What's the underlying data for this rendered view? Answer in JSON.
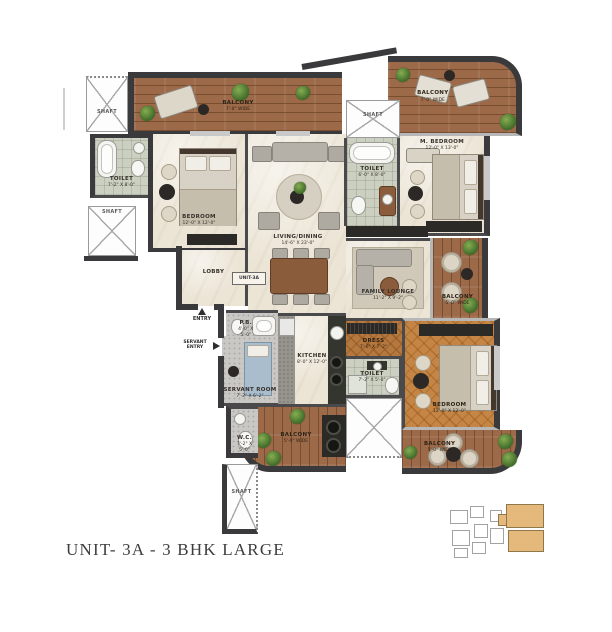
{
  "title": "UNIT- 3A - 3 BHK LARGE",
  "plan": {
    "unit_tag": "UNIT-3A",
    "entry_label": "ENTRY",
    "servant_entry_label": "SERVANT ENTRY"
  },
  "rooms": {
    "shaft_top_left": {
      "name": "SHAFT",
      "dims": ""
    },
    "balcony_top": {
      "name": "BALCONY",
      "dims": "7'-0\" WIDE"
    },
    "balcony_top_right": {
      "name": "BALCONY",
      "dims": "7'-0\" WIDE"
    },
    "shaft_center": {
      "name": "SHAFT",
      "dims": ""
    },
    "toilet_left": {
      "name": "TOILET",
      "dims": "7'-2\" X 8'-0\""
    },
    "shaft_left": {
      "name": "SHAFT",
      "dims": ""
    },
    "bedroom_left": {
      "name": "BEDROOM",
      "dims": "12'-0\" X 12'-0\""
    },
    "living_dining": {
      "name": "LIVING/DINING",
      "dims": "14'-6\" X 23'-0\""
    },
    "lobby": {
      "name": "LOBBY",
      "dims": ""
    },
    "toilet_master": {
      "name": "TOILET",
      "dims": "6'-0\" X 8'-0\""
    },
    "master_bedroom": {
      "name": "M. BEDROOM",
      "dims": "12'-0\" X 13'-0\""
    },
    "family_lounge": {
      "name": "FAMILY LOUNGE",
      "dims": "11'-2\" X 9'-2\""
    },
    "balcony_right": {
      "name": "BALCONY",
      "dims": "5'-0\" WIDE"
    },
    "dress": {
      "name": "DRESS",
      "dims": "7'-0\" X 7'-2\""
    },
    "toilet_bottom": {
      "name": "TOILET",
      "dims": "7'-2\" X 5'-0\""
    },
    "bedroom_right": {
      "name": "BEDROOM",
      "dims": "12'-0\" X 12'-0\""
    },
    "balcony_bottom_right": {
      "name": "BALCONY",
      "dims": "5'-0\" WIDE"
    },
    "balcony_bottom_left": {
      "name": "BALCONY",
      "dims": "5'-0\" WIDE"
    },
    "kitchen": {
      "name": "KITCHEN",
      "dims": "8'-0\" X 12'-0\""
    },
    "powder_bath": {
      "name": "P.B.",
      "dims": "4'-0\" X 5'-0\""
    },
    "servant_room": {
      "name": "SERVANT ROOM",
      "dims": "7'-2\" X 6'-2\""
    },
    "wc": {
      "name": "W.C.",
      "dims": "7'-2\" X 5'-0\""
    },
    "shaft_bottom": {
      "name": "SHAFT",
      "dims": ""
    }
  },
  "colors": {
    "wall": "#3a3a3c",
    "wood_floor": "#9c6a48",
    "herringbone_floor": "#c58544",
    "marble_floor": "#ece5d6",
    "tile_floor": "#ccd0c0",
    "keyplan_highlight": "#e5b87b"
  }
}
